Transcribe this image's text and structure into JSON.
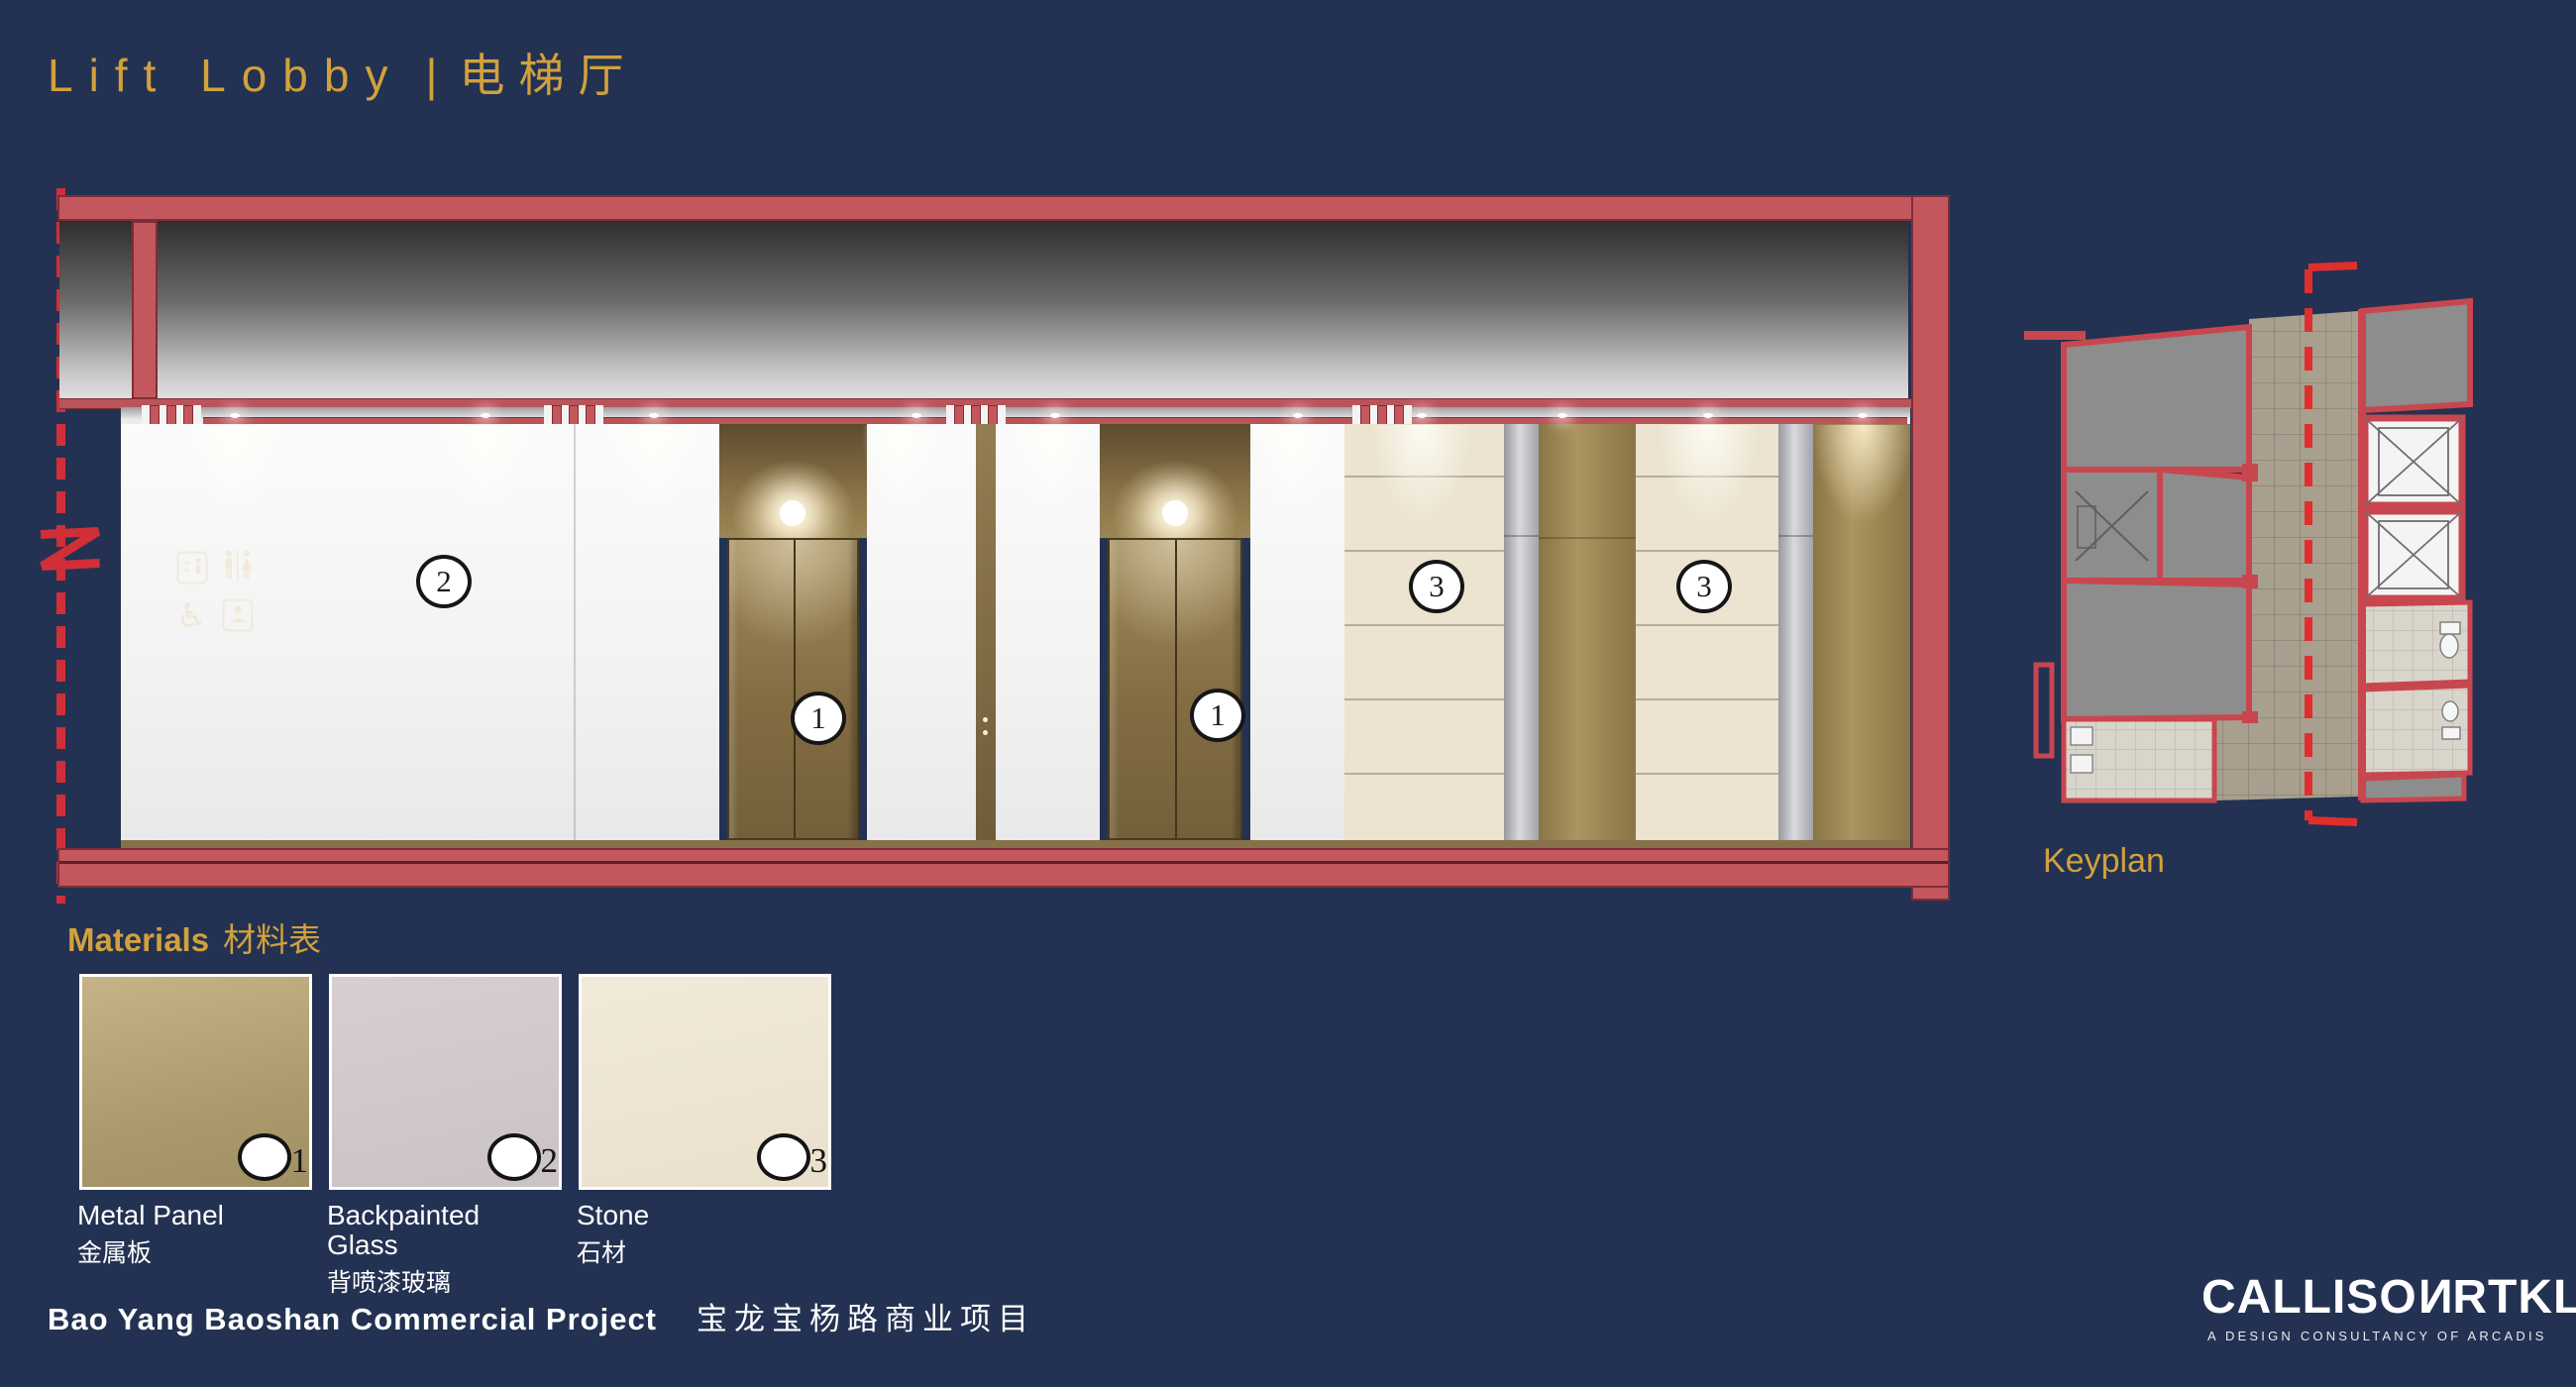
{
  "slide": {
    "title_en": "Lift Lobby",
    "title_sep": "|",
    "title_zh": "电梯厅"
  },
  "elevation": {
    "labels": [
      {
        "id": "2"
      },
      {
        "id": "1"
      },
      {
        "id": "1"
      },
      {
        "id": "3"
      },
      {
        "id": "3"
      }
    ],
    "signage_icons": [
      "lift-icon",
      "restroom-icon",
      "wheelchair-icon",
      "baby-care-icon"
    ]
  },
  "keyplan": {
    "label": "Keyplan"
  },
  "materials": {
    "header_en": "Materials",
    "header_zh": "材料表",
    "items": [
      {
        "num": "1",
        "name_en": "Metal Panel",
        "name_zh": "金属板",
        "swatch_color": "#b3a176"
      },
      {
        "num": "2",
        "name_en": "Backpainted Glass",
        "name_zh": "背喷漆玻璃",
        "swatch_color": "#cfc6c8"
      },
      {
        "num": "3",
        "name_en": "Stone",
        "name_zh": "石材",
        "swatch_color": "#ece4d2"
      }
    ]
  },
  "footer": {
    "project_en": "Bao Yang Baoshan Commercial Project",
    "project_zh": "宝龙宝杨路商业项目",
    "logo_prefix": "CALLISO",
    "logo_reversed_n": "N",
    "logo_suffix": "RTKL",
    "logo_tagline": "A DESIGN CONSULTANCY OF ARCADIS"
  },
  "colors": {
    "background": "#233252",
    "accent_gold": "#d2a13c",
    "section_red": "#c4575e",
    "dashed_red": "#d02f38",
    "wall_white": "#f3f3f3",
    "bronze": "#8a7347",
    "stone": "#ece4d0",
    "text_white": "#ffffff"
  }
}
